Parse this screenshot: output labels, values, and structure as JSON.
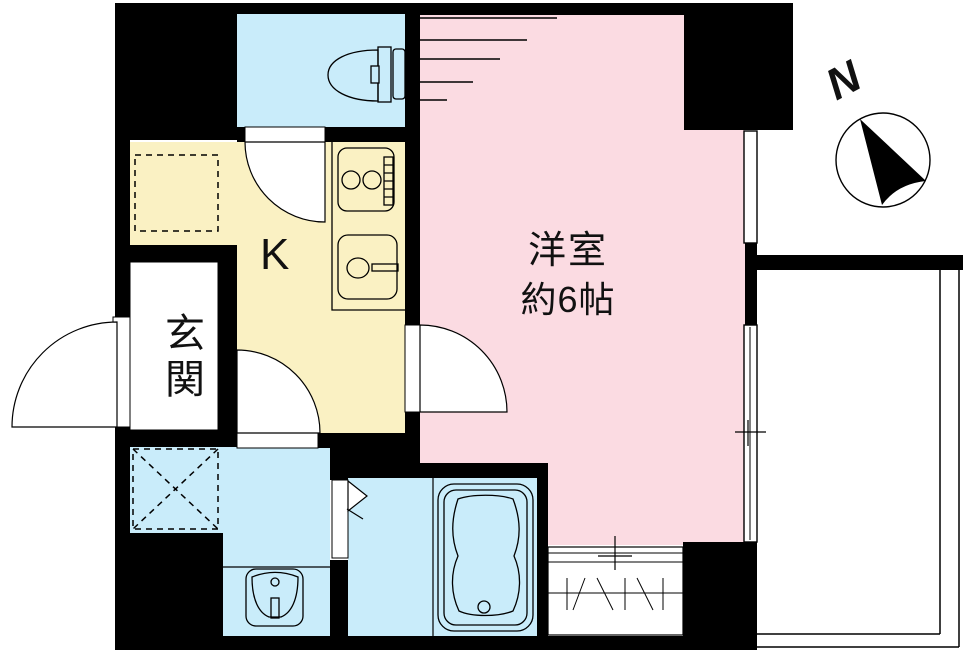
{
  "rooms": {
    "western": {
      "line1": "洋室",
      "line2": "約6帖"
    },
    "kitchen": {
      "label": "K"
    },
    "entrance": {
      "label": "玄関"
    }
  },
  "compass": {
    "label": "N"
  },
  "colors": {
    "bg": "#FFFFFF",
    "wall": "#000000",
    "line": "#000000",
    "pink": "#FBDBE2",
    "yellow": "#FAF1C3",
    "blue": "#C9ECFA"
  }
}
